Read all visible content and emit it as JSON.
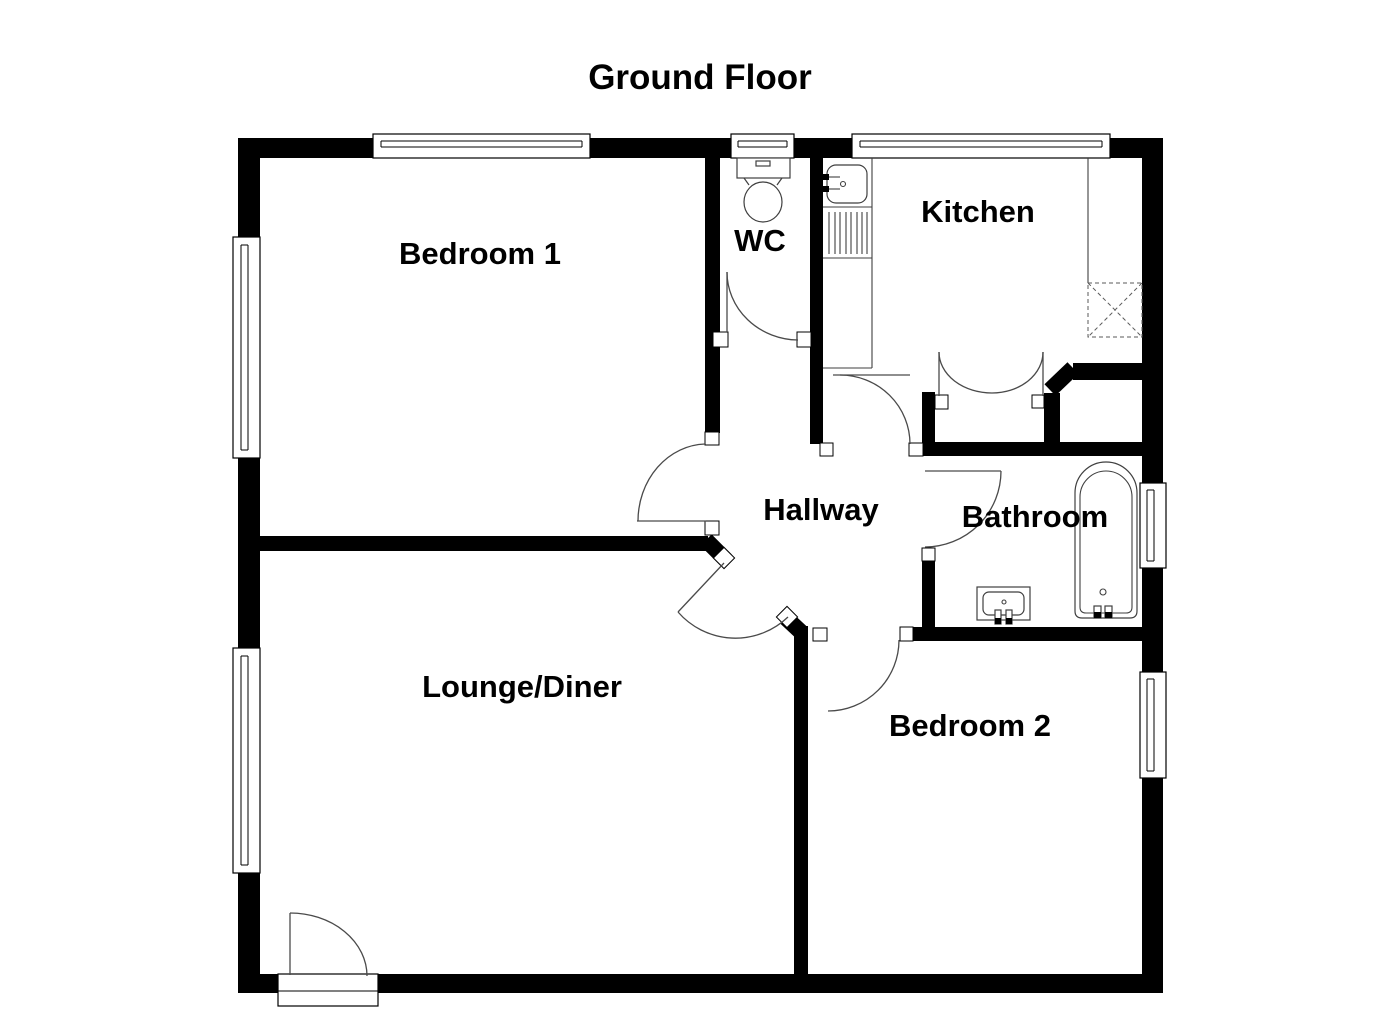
{
  "title": "Ground Floor",
  "rooms": {
    "bedroom1": {
      "label": "Bedroom 1"
    },
    "wc": {
      "label": "WC"
    },
    "kitchen": {
      "label": "Kitchen"
    },
    "hallway": {
      "label": "Hallway"
    },
    "bathroom": {
      "label": "Bathroom"
    },
    "lounge_diner": {
      "label": "Lounge/Diner"
    },
    "bedroom2": {
      "label": "Bedroom 2"
    }
  },
  "fixtures": {
    "toilet": "toilet",
    "kitchen_sink": "kitchen sink with taps and drainer",
    "appliance_space": "appliance space (dashed)",
    "bathtub": "bathtub with taps",
    "wash_basin": "wash basin with taps",
    "cupboard": "double-door storage cupboard",
    "front_door": "front entrance door"
  },
  "colors": {
    "walls": "#000000",
    "background": "#ffffff",
    "detail_lines": "#4a4a4a"
  }
}
